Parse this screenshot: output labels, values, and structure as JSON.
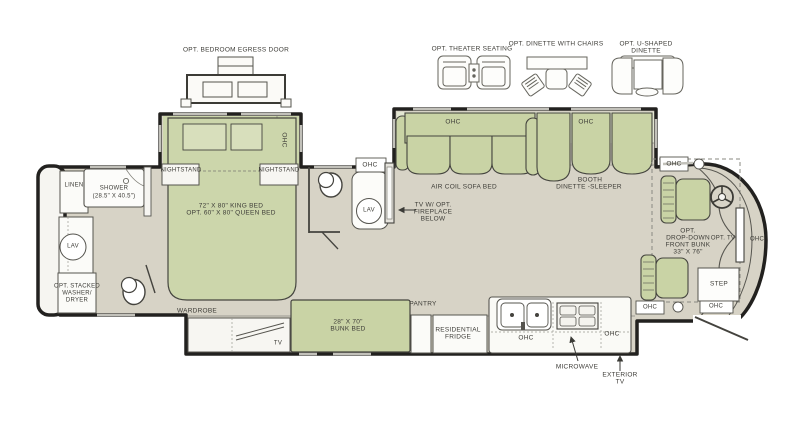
{
  "title": "RV floor plan",
  "colors": {
    "floor": "#d7d3c6",
    "furniture_green": "#c9d3a5",
    "furniture_green_light": "#e3e7d2",
    "wall": "#22211f",
    "fixture_white": "#f9f8f4",
    "label_text": "#3d3c37"
  },
  "options_row": {
    "egress_door": "OPT. BEDROOM EGRESS DOOR",
    "theater": "OPT. THEATER SEATING",
    "dinette_chairs": "OPT. DINETTE WITH CHAIRS",
    "u_dinette_line1": "OPT. U-SHAPED",
    "u_dinette_line2": "DINETTE"
  },
  "bedroom": {
    "slide_ohc": "OHC",
    "nightstand_left": "NIGHTSTAND",
    "nightstand_right": "NIGHTSTAND",
    "bed_line1": "72\" X 80\" KING BED",
    "bed_line2": "OPT. 60\" X 80\" QUEEN BED",
    "wardrobe": "WARDROBE",
    "tv": "TV"
  },
  "rear_bath": {
    "linen": "LINEN",
    "shower_line1": "SHOWER",
    "shower_line2": "(28.5\" X 40.5\")",
    "lav": "LAV",
    "washer_line1": "OPT. STACKED",
    "washer_line2": "WASHER/",
    "washer_line3": "DRYER"
  },
  "mid_bath": {
    "ohc": "OHC",
    "lav": "LAV"
  },
  "living": {
    "sofa_ohc": "OHC",
    "booth_ohc": "OHC",
    "sofa": "AIR COIL SOFA BED",
    "booth_line1": "BOOTH",
    "booth_line2": "DINETTE -SLEEPER",
    "tv_fireplace_line1": "TV W/ OPT.",
    "tv_fireplace_line2": "FIREPLACE",
    "tv_fireplace_line3": "BELOW"
  },
  "galley": {
    "bunk_line1": "28\" X 70\"",
    "bunk_line2": "BUNK BED",
    "pantry": "PANTRY",
    "fridge_line1": "RESIDENTIAL",
    "fridge_line2": "FRIDGE",
    "ohc_left": "OHC",
    "ohc_right": "OHC",
    "microwave": "MICROWAVE",
    "exterior_tv_line1": "EXTERIOR",
    "exterior_tv_line2": "TV"
  },
  "cab": {
    "ohc_overhead": "OHC",
    "front_bunk_line1": "OPT.",
    "front_bunk_line2": "DROP-DOWN",
    "front_bunk_line3": "FRONT BUNK",
    "front_bunk_line4": "33\" X 76\"",
    "opt_tv": "OPT. TV",
    "dash_ohc": "OHC",
    "step": "STEP",
    "entry_ohc_left": "OHC",
    "entry_ohc_right": "OHC"
  }
}
